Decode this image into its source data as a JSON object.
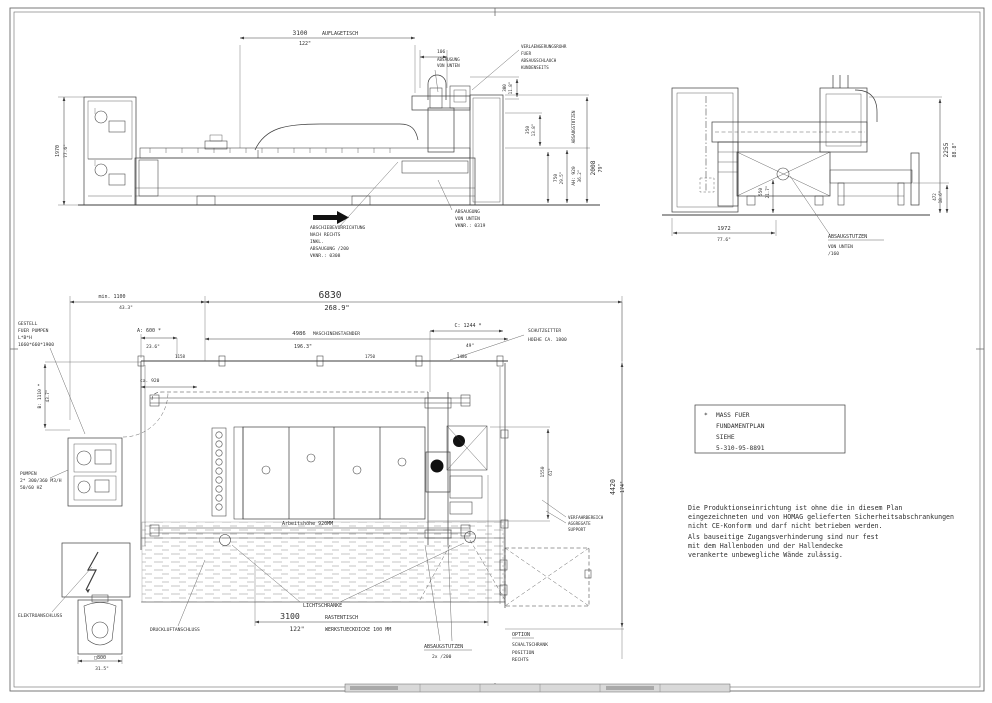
{
  "sheet": {
    "background": "#ffffff",
    "line_color": "#3d3d3d",
    "accent_black": "#111111"
  },
  "front_view": {
    "dim_3100": {
      "mm": "3100",
      "label": "AUFLAGETISCH",
      "inch": "122\""
    },
    "dim_106": {
      "mm": "106"
    },
    "absaugung_von_unten": [
      "ABSAUGUNG",
      "VON UNTEN"
    ],
    "verlaengerung": [
      "VERLAENGERUNGSROHR",
      "FUER",
      "ABSAUGSCHLAUCH",
      "KUNDENSEITS"
    ],
    "dim_300": {
      "mm": "300",
      "inch": "11.8\""
    },
    "dim_350": {
      "mm": "350",
      "inch": "13.8\""
    },
    "dim_750": {
      "mm": "750",
      "inch": "29.5\""
    },
    "dim_ah": {
      "mm": "AH: 920",
      "inch": "36.2\""
    },
    "dim_2008": {
      "mm": "2008",
      "inch": "79\""
    },
    "absaugstutzen_vertical": "ABSAUGSTUTZEN",
    "dim_1970": {
      "mm": "1970",
      "inch": "77.6\""
    },
    "abschiebevorrichtung": [
      "ABSCHIEBEVORRICHTUNG",
      "NACH RECHTS",
      "INKL.",
      "ABSAUGUNG /200",
      "VKNR.: 0308"
    ],
    "absaugung_vknr": [
      "ABSAUGUNG",
      "VON UNTEN",
      "VKNR.: 0319"
    ]
  },
  "side_view": {
    "dim_2255": {
      "mm": "2255",
      "inch": "88.8\""
    },
    "dim_550": {
      "mm": "550",
      "inch": "21.7\""
    },
    "dim_472": {
      "mm": "472",
      "inch": "18.6\""
    },
    "dim_1972": {
      "mm": "1972",
      "inch": "77.6\""
    },
    "absaugstutzen": [
      "ABSAUGSTUTZEN",
      "VON UNTEN",
      "/160"
    ]
  },
  "plan_view": {
    "dim_min1100": {
      "mm": "min. 1100",
      "inch": "43.3\""
    },
    "dim_6830": {
      "mm": "6830",
      "inch": "268.9\""
    },
    "dim_a600": {
      "mm": "A: 600 *",
      "inch": "23.6\""
    },
    "dim_4986": {
      "mm": "4986",
      "label": "MASCHINENSTAENDER",
      "inch": "196.3\""
    },
    "dim_c1244": {
      "mm": "C: 1244 *",
      "inch": "49\""
    },
    "schutzgitter": [
      "SCHUTZGITTER",
      "HOEHE CA. 1800"
    ],
    "gestell_pumpen": [
      "GESTELL",
      "FUER PUMPEN",
      "L*B*H",
      "1660*660*1900"
    ],
    "dim_b1110": {
      "mm": "B: 1110 *",
      "inch": "43.7\""
    },
    "dim_ca920": "ca. 920",
    "segment_dims": [
      "1158",
      "1750",
      "1486"
    ],
    "pumpen": [
      "PUMPEN",
      "2* 300/360 M3/H",
      "50/60 HZ"
    ],
    "dim_1550": {
      "mm": "1550",
      "inch": "61\""
    },
    "dim_4420": {
      "mm": "4420",
      "inch": "174\""
    },
    "arbeitshoehe": "Arbeitshöhe 920MM",
    "lichtschranke": "LICHTSCHRANKE",
    "dim_3100": {
      "mm": "3100",
      "inch": "122\""
    },
    "rastentisch": [
      "RASTENTISCH",
      "WERKSTUECKDICKE 100 MM"
    ],
    "absaugstutzen": [
      "ABSAUGSTUTZEN",
      "2x /200"
    ],
    "option": [
      "OPTION",
      "SCHALTSCHRANK",
      "POSITION",
      "RECHTS"
    ],
    "elektroanschluss": "ELEKTROANSCHLUSS",
    "druckluftanschluss": "DRUCKLUFTANSCHLUSS",
    "dim_800": {
      "mm": "□800",
      "inch": "31.5\""
    },
    "verfahrbereich": [
      "VERFAHRBEREICH",
      "AGGREGATE",
      "SUPPORT"
    ]
  },
  "notes": {
    "fundament_box": [
      "*",
      "MASS FUER",
      "FUNDAMENTPLAN",
      "SIEHE",
      "5-310-95-8891"
    ],
    "ce_note": [
      "Die Produktionseinrichtung ist ohne die in diesem Plan",
      "eingezeichneten und von HOMAG gelieferten Sicherheitsabschrankungen",
      "nicht CE-Konform und darf nicht betrieben werden.",
      "Als bauseitige Zugangsverhinderung sind nur fest",
      "mit dem Hallenboden und der Hallendecke",
      "verankerte unbewegliche Wände zulässig."
    ]
  }
}
